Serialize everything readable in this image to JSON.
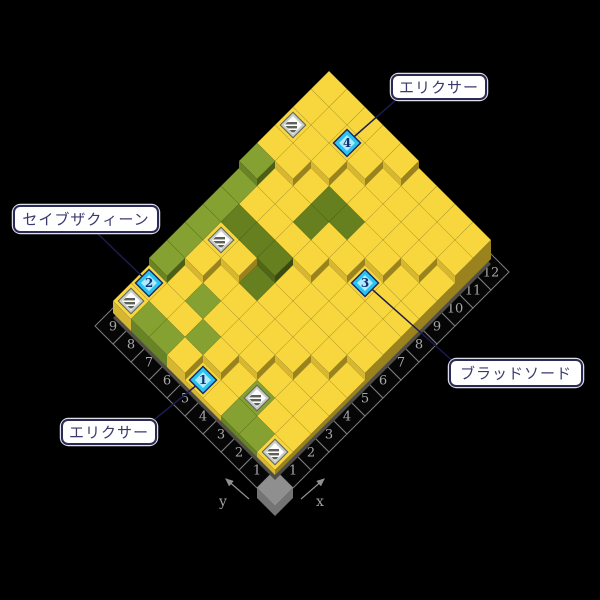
{
  "map": {
    "cols": 12,
    "rows": 9,
    "tiles": [
      "yyggggggyyyy",
      "gyyyyGyyyyyy",
      "gygyyGyyyyyy",
      "ygyyGGyGGyyy",
      "yyyyyyyyGyyy",
      "yyyyyyyyyyyy",
      "ggyyyyyyyyyy",
      "gyyyyyyyyyyy",
      "yyyyyyyyyyyy"
    ],
    "chests": [
      [
        1,
        1
      ],
      [
        2,
        3
      ],
      [
        1,
        9
      ],
      [
        5,
        8
      ],
      [
        10,
        9
      ]
    ],
    "markers": [
      {
        "n": "1",
        "x": 1,
        "y": 5
      },
      {
        "n": "2",
        "x": 2,
        "y": 9
      },
      {
        "n": "3",
        "x": 8,
        "y": 3
      },
      {
        "n": "4",
        "x": 11,
        "y": 7
      }
    ]
  },
  "annotations": [
    {
      "id": "elixir-top",
      "text": "エリクサー",
      "box": [
        392,
        75,
        94,
        24
      ],
      "start": [
        397,
        99
      ],
      "marker": "4"
    },
    {
      "id": "save-the-queen",
      "text": "セイブザクィーン",
      "box": [
        14,
        206,
        144,
        26
      ],
      "start": [
        97,
        233
      ],
      "marker": "2"
    },
    {
      "id": "blood-sword",
      "text": "ブラッドソード",
      "box": [
        450,
        360,
        132,
        26
      ],
      "start": [
        455,
        363
      ],
      "marker": "3"
    },
    {
      "id": "elixir-bottom",
      "text": "エリクサー",
      "box": [
        62,
        420,
        94,
        24
      ],
      "start": [
        155,
        419
      ],
      "marker": "1"
    }
  ],
  "axes": {
    "x": {
      "label": "x",
      "ticks": [
        "1",
        "2",
        "3",
        "4",
        "5",
        "6",
        "7",
        "8",
        "9",
        "10",
        "11",
        "12"
      ]
    },
    "y": {
      "label": "y",
      "ticks": [
        "1",
        "2",
        "3",
        "4",
        "5",
        "6",
        "7",
        "8",
        "9"
      ]
    }
  },
  "palette": {
    "bg": "#000000",
    "base": "#4F4D46",
    "tileY": {
      "top": "#F8D73E",
      "left": "#D8B730",
      "right": "#9A831F"
    },
    "tileG": {
      "top": "#84A131",
      "left": "#698327",
      "right": "#4C5F17"
    },
    "tileGD": {
      "top": "#66801F",
      "left": "#526617",
      "right": "#3A4A10"
    },
    "axisTile": {
      "fill": "#060606",
      "stroke": "#7C7C7C",
      "text": "#A8A8A8"
    },
    "cornerBlock": {
      "top": "#8F8F8F",
      "side": "#747474"
    },
    "marker": {
      "border": "#1E2A66",
      "ring": "#29C5F2",
      "inner": "#AEEBFF",
      "digit": "#153070"
    },
    "chest": {
      "outer": "#60635A",
      "band": "#C9CDC9",
      "inner": "#FFFFFF",
      "stripe": "#5E6158"
    },
    "leader": "#1B1B4E",
    "labelBox": {
      "bg": "#FFFFFF",
      "border": "#2A2A55",
      "rim": "#DFDFEA",
      "text": "#3A3A70"
    },
    "arrow": "#8F8F8F",
    "arrowText": "#9F9FA8"
  },
  "geometry": {
    "originX": 275,
    "originY": 488,
    "half": 18,
    "liftStep": 7,
    "sideSkirt": 5,
    "arrows": {
      "x": {
        "from": [
          301,
          499
        ],
        "to": [
          324,
          479
        ],
        "labelAt": [
          320,
          506
        ]
      },
      "y": {
        "from": [
          249,
          499
        ],
        "to": [
          226,
          479
        ],
        "labelAt": [
          223,
          506
        ]
      }
    }
  }
}
